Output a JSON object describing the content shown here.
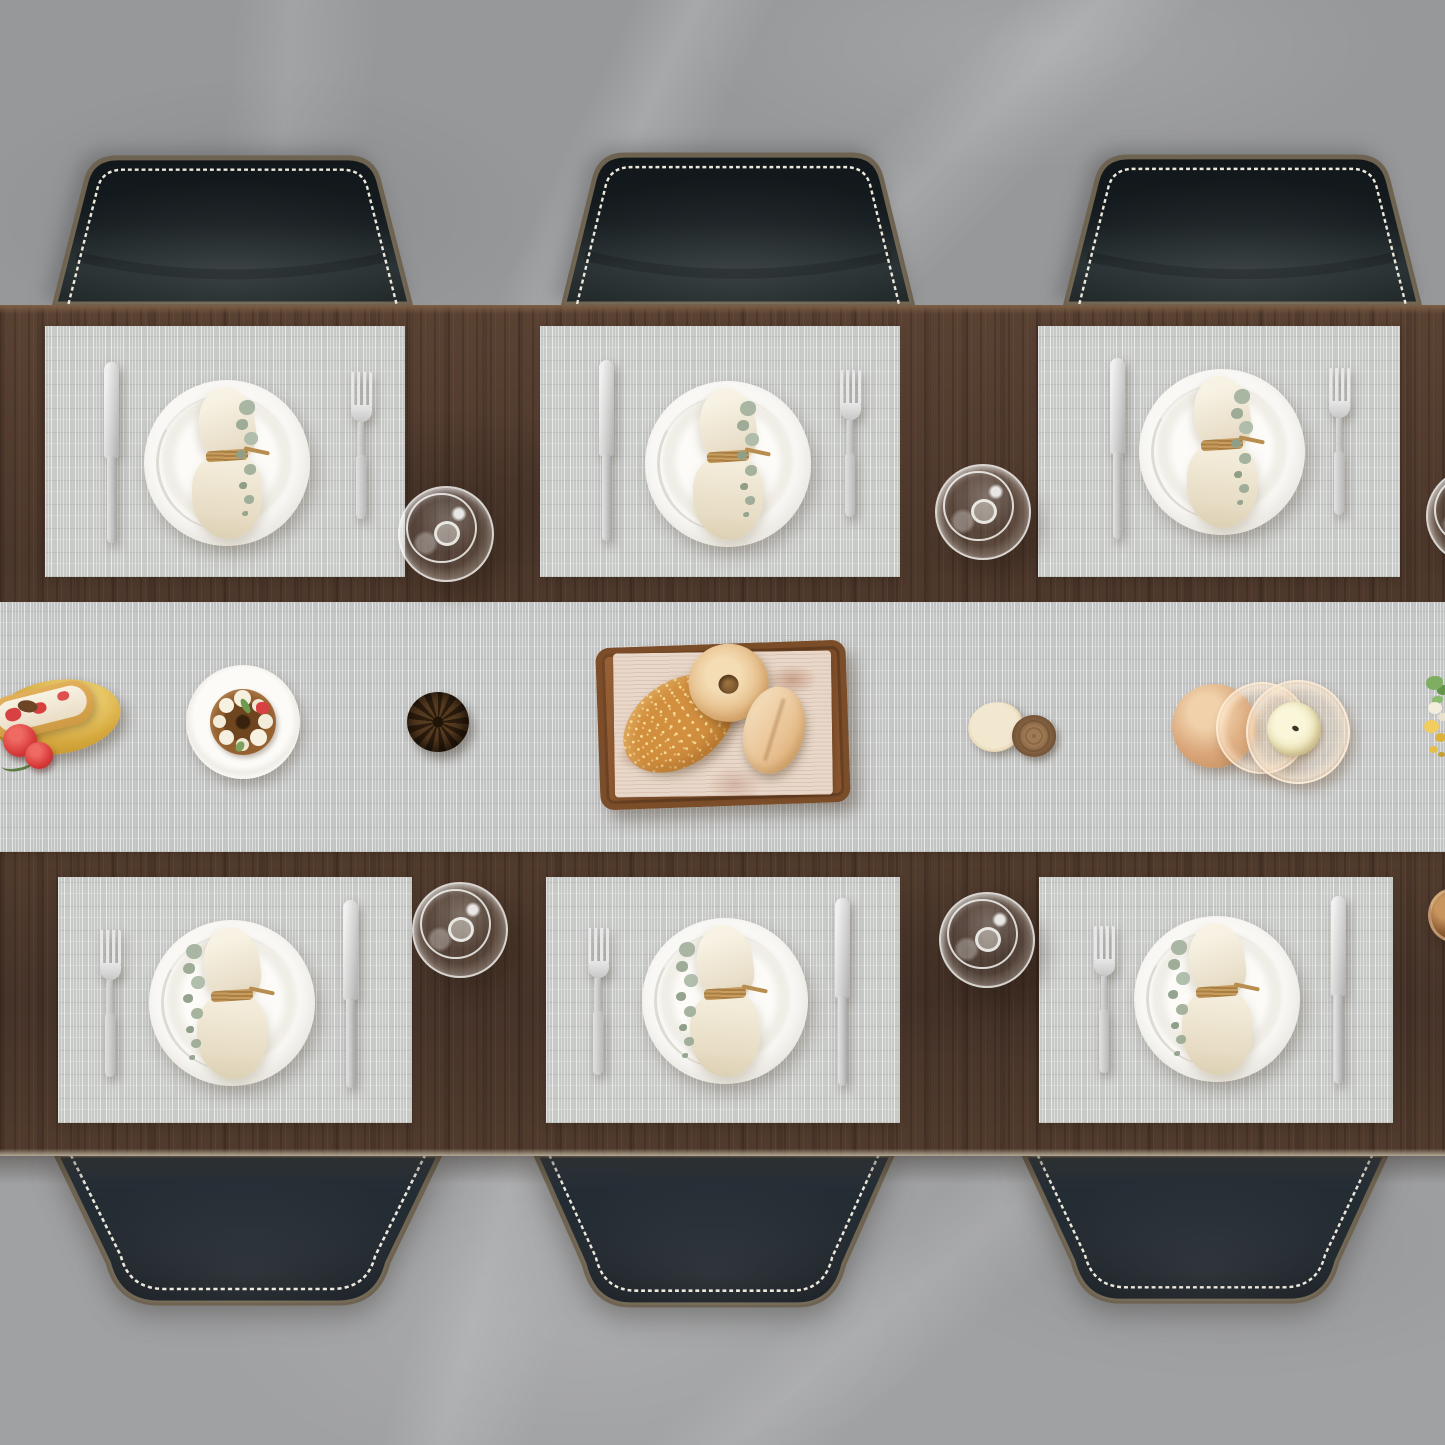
{
  "meta": {
    "type": "photograph",
    "view": "top-down",
    "subject": "Walnut dining table set for six with gray bamboo-weave placemats and matching table runner on a gray marble floor"
  },
  "palette": {
    "floor_top": "#97989a",
    "floor_bottom": "#a0a1a3",
    "wood": "#533c2e",
    "table_edge": "#7d5f45",
    "mat": "#c7c9c7",
    "runner": "#c2c4c3",
    "leather_dark": "#12181b",
    "leather_light": "#2a3336",
    "chair_rim": "#6e6350",
    "stitch": "#ece8db",
    "plate": "#f7f6f3",
    "napkin": "#ece3d1",
    "twine": "#c79c5e",
    "eucalyptus": "#a6b4a0",
    "silver": "#d9d9d7",
    "bread_gold": "#d28f3e",
    "parchment": "#e9d8c9",
    "candle": "#efe7bd",
    "amber_glass": "#dfac7d",
    "strawberry": "#d84141",
    "leaf_green": "#7fae62",
    "flower_yellow": "#f0cd5d"
  },
  "scene": {
    "chairs": {
      "count": 6,
      "label": "black leather dining chair with tan rim and cream cross-stitch trim"
    },
    "placemats": {
      "count": 6,
      "label": "light gray woven bamboo-look placemat"
    },
    "runner": {
      "label": "matching gray woven table runner across the table center"
    },
    "place_settings": {
      "count": 6,
      "label": "place setting: white plate, linen napkin tied with twine, eucalyptus sprig, stainless knife and fork",
      "parts": [
        "white plate",
        "linen napkin",
        "twine tie",
        "eucalyptus sprig",
        "knife",
        "fork"
      ]
    },
    "glasses": {
      "count": 5,
      "label": "empty wine glass seen from above"
    },
    "centerpieces": [
      {
        "id": "eclair-board",
        "label": "strawberry cream eclair and berries on a golden board (left edge of frame)"
      },
      {
        "id": "dessert-plate",
        "label": "chocolate dessert with cream dollops, strawberry and mint on a white plate"
      },
      {
        "id": "pinecone",
        "label": "pinecone"
      },
      {
        "id": "bread-tray",
        "label": "wooden tray with newsprint parchment, sesame loaf, donut and floured roll"
      },
      {
        "id": "birch-slices",
        "label": "two birch log slice decorations"
      },
      {
        "id": "candle-holder",
        "label": "amber glass candle holders with a cream pillar candle"
      },
      {
        "id": "flowers",
        "label": "yellow and white flowers with green leaves (right edge of frame)"
      },
      {
        "id": "amber-cup",
        "label": "amber glass cup (right edge of frame)"
      }
    ]
  }
}
